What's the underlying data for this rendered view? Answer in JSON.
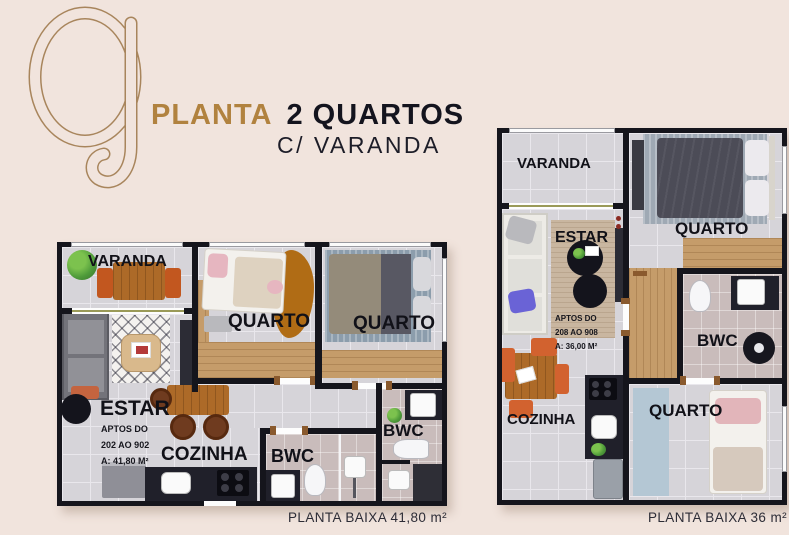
{
  "title": {
    "planta": "PLANTA",
    "quartos": "2 QUARTOS",
    "varanda_line": "C/ VARANDA"
  },
  "colors": {
    "background": "#f1e4dd",
    "gold": "#b1823f",
    "title_dark": "#14141e",
    "wall": "#15151c",
    "floor": "#d6d4d9",
    "floor_bath": "#c9bcbb",
    "wood": "#c59c6a",
    "accent_orange": "#d2622f"
  },
  "plans": {
    "left": {
      "caption": "PLANTA BAIXA 41,80 m²",
      "labels": {
        "varanda": "VARANDA",
        "quarto1": "QUARTO",
        "quarto2": "QUARTO",
        "estar": "ESTAR",
        "cozinha": "COZINHA",
        "bwc1": "BWC",
        "bwc2": "BWC"
      },
      "info": {
        "line1": "APTOS DO",
        "line2": "202 AO 902",
        "line3": "A: 41,80 M²"
      }
    },
    "right": {
      "caption": "PLANTA BAIXA 36 m²",
      "labels": {
        "varanda": "VARANDA",
        "quarto1": "QUARTO",
        "estar": "ESTAR",
        "bwc": "BWC",
        "cozinha": "COZINHA",
        "quarto2": "QUARTO"
      },
      "info": {
        "line1": "APTOS DO",
        "line2": "208 AO 908",
        "line3": "A: 36,00 M²"
      }
    }
  }
}
